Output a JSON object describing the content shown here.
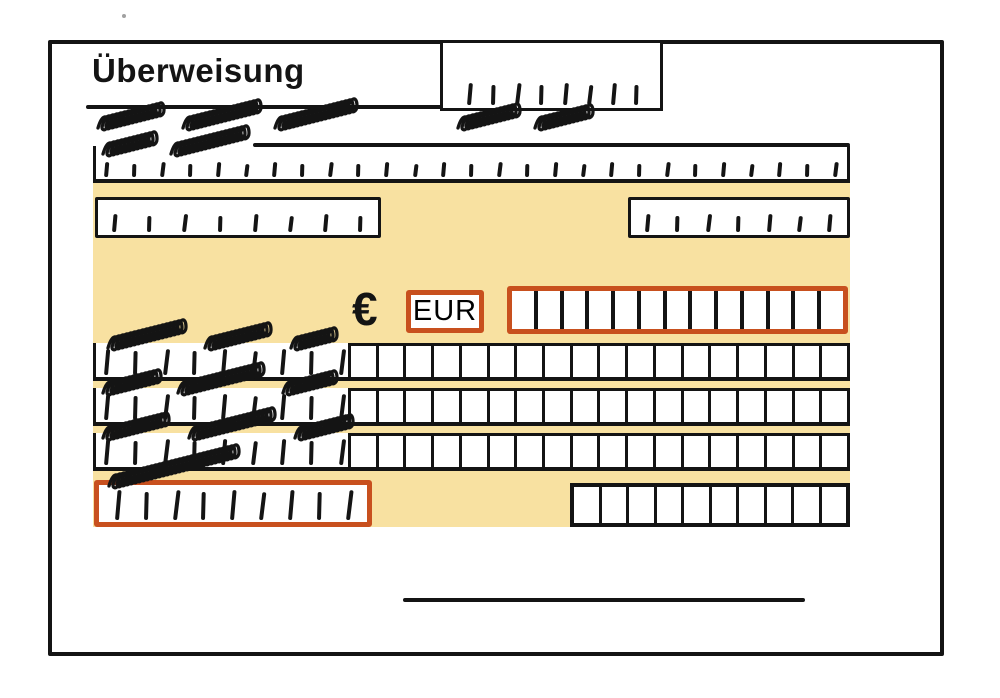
{
  "header": {
    "title": "Überweisung"
  },
  "amount": {
    "currency_symbol": "€",
    "currency_code": "EUR",
    "cells": 13
  },
  "reference_box": {
    "ticks": 8
  },
  "top_entry_row": {
    "ticks": 27
  },
  "account_boxes": {
    "left_ticks": 8,
    "right_ticks": 7
  },
  "char_rows": {
    "count": 3,
    "ticks": 9,
    "cells": 18
  },
  "bottom_row": {
    "left_box_ticks": 9,
    "right_box_cells": 10
  },
  "colors": {
    "ink": "#141414",
    "accent": "#C8501E",
    "highlight": "#F8E1A1"
  }
}
